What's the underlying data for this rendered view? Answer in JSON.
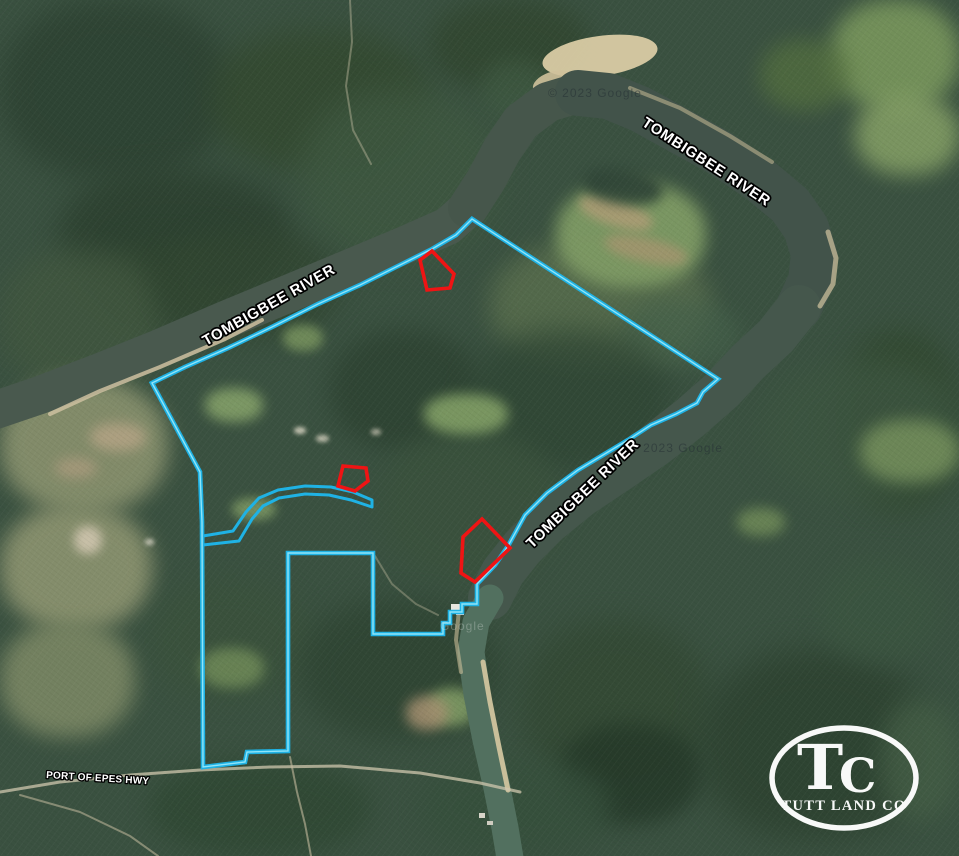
{
  "canvas": {
    "width": 959,
    "height": 856
  },
  "labels": {
    "river": [
      {
        "text": "TOMBIGBEE RIVER",
        "x": 641,
        "y": 125,
        "rotate": 33
      },
      {
        "text": "TOMBIGBEE RIVER",
        "x": 206,
        "y": 346,
        "rotate": -29.5
      },
      {
        "text": "TOMBIGBEE RIVER",
        "x": 532,
        "y": 549,
        "rotate": -44
      }
    ],
    "road": {
      "text": "PORT OF EPES HWY",
      "x": 46,
      "y": 778,
      "rotate": 3.5
    },
    "watermarks": [
      {
        "text": "© 2023 Google",
        "x": 548,
        "y": 97,
        "tone": "dark"
      },
      {
        "text": "© 2023 Google",
        "x": 629,
        "y": 452,
        "tone": "dark"
      },
      {
        "text": "Google",
        "x": 440,
        "y": 630,
        "tone": "light"
      }
    ]
  },
  "logo": {
    "monogram_t": "T",
    "monogram_c": "C",
    "name": "TUTT LAND CO"
  },
  "colors": {
    "boundary": "#1fb2e4",
    "boundary_core": "#9beafb",
    "outparcel": "#ef1414",
    "water": "#49594e",
    "sand": "#d5c7a0",
    "label_fill": "#ffffff",
    "label_stroke": "#000000"
  },
  "geometry": {
    "boundary": [
      [
        152,
        383
      ],
      [
        185,
        367
      ],
      [
        228,
        348
      ],
      [
        272,
        327
      ],
      [
        318,
        304
      ],
      [
        360,
        285
      ],
      [
        400,
        265
      ],
      [
        432,
        249
      ],
      [
        456,
        235
      ],
      [
        472,
        219
      ],
      [
        718,
        379
      ],
      [
        703,
        392
      ],
      [
        697,
        403
      ],
      [
        676,
        414
      ],
      [
        651,
        425
      ],
      [
        628,
        440
      ],
      [
        598,
        458
      ],
      [
        578,
        470
      ],
      [
        547,
        493
      ],
      [
        525,
        515
      ],
      [
        508,
        546
      ],
      [
        495,
        565
      ],
      [
        477,
        584
      ],
      [
        477,
        604
      ],
      [
        462,
        604
      ],
      [
        462,
        612
      ],
      [
        450,
        612
      ],
      [
        450,
        623
      ],
      [
        443,
        623
      ],
      [
        443,
        634
      ],
      [
        373,
        634
      ],
      [
        373,
        553
      ],
      [
        288,
        553
      ],
      [
        288,
        751
      ],
      [
        247,
        752
      ],
      [
        245,
        762
      ],
      [
        203,
        767
      ],
      [
        202,
        522
      ],
      [
        200,
        472
      ]
    ],
    "corridor": [
      [
        203,
        536
      ],
      [
        233,
        531
      ],
      [
        246,
        512
      ],
      [
        259,
        498
      ],
      [
        278,
        490
      ],
      [
        305,
        486
      ],
      [
        331,
        487
      ],
      [
        353,
        492
      ],
      [
        372,
        500
      ],
      [
        372,
        507
      ],
      [
        351,
        500
      ],
      [
        329,
        495
      ],
      [
        305,
        494
      ],
      [
        279,
        498
      ],
      [
        263,
        506
      ],
      [
        252,
        519
      ],
      [
        239,
        541
      ],
      [
        203,
        545
      ]
    ],
    "outparcels": [
      [
        [
          420,
          260
        ],
        [
          432,
          251
        ],
        [
          454,
          274
        ],
        [
          450,
          288
        ],
        [
          427,
          290
        ]
      ],
      [
        [
          343,
          466
        ],
        [
          366,
          468
        ],
        [
          368,
          481
        ],
        [
          355,
          491
        ],
        [
          338,
          486
        ]
      ],
      [
        [
          482,
          519
        ],
        [
          510,
          548
        ],
        [
          475,
          582
        ],
        [
          461,
          573
        ],
        [
          463,
          537
        ]
      ]
    ],
    "rivers": [
      {
        "points": [
          [
            -10,
            412
          ],
          [
            40,
            395
          ],
          [
            100,
            372
          ],
          [
            160,
            348
          ],
          [
            225,
            320
          ],
          [
            290,
            293
          ],
          [
            350,
            268
          ],
          [
            405,
            245
          ],
          [
            448,
            226
          ],
          [
            468,
            208
          ]
        ],
        "width": 38,
        "color": "#49594e"
      },
      {
        "points": [
          [
            468,
            208
          ],
          [
            486,
            180
          ],
          [
            502,
            150
          ],
          [
            521,
            122
          ],
          [
            548,
            102
          ],
          [
            578,
            93
          ]
        ],
        "width": 40,
        "color": "#46564b"
      },
      {
        "points": [
          [
            578,
            93
          ],
          [
            608,
            96
          ],
          [
            640,
            109
          ],
          [
            678,
            130
          ],
          [
            718,
            152
          ],
          [
            760,
            180
          ],
          [
            790,
            205
          ],
          [
            806,
            228
          ],
          [
            814,
            254
          ],
          [
            811,
            281
          ],
          [
            799,
            307
          ]
        ],
        "width": 46,
        "color": "#42534a"
      },
      {
        "points": [
          [
            799,
            307
          ],
          [
            776,
            336
          ],
          [
            748,
            362
          ],
          [
            722,
            390
          ],
          [
            690,
            418
          ],
          [
            654,
            446
          ],
          [
            616,
            472
          ],
          [
            580,
            496
          ],
          [
            548,
            522
          ],
          [
            522,
            548
          ],
          [
            503,
            572
          ],
          [
            490,
            598
          ]
        ],
        "width": 44,
        "color": "#45574c"
      },
      {
        "points": [
          [
            490,
            598
          ],
          [
            476,
            622
          ],
          [
            471,
            652
          ],
          [
            477,
            694
          ],
          [
            486,
            740
          ],
          [
            497,
            788
          ],
          [
            505,
            828
          ],
          [
            510,
            858
          ]
        ],
        "width": 27,
        "color": "#52705f"
      }
    ],
    "beaches": [
      {
        "cx": 600,
        "cy": 56,
        "rx": 58,
        "ry": 20,
        "rot": -8,
        "color": "#d9cba4",
        "op": 0.95
      },
      {
        "cx": 552,
        "cy": 82,
        "rx": 20,
        "ry": 10,
        "rot": -20,
        "color": "#cfc19b",
        "op": 0.9
      }
    ],
    "sandbars": [
      {
        "points": [
          [
            50,
            414
          ],
          [
            100,
            391
          ],
          [
            160,
            367
          ],
          [
            225,
            339
          ],
          [
            262,
            320
          ]
        ],
        "width": 4,
        "color": "#cdbfa0",
        "op": 0.85
      },
      {
        "points": [
          [
            630,
            88
          ],
          [
            680,
            108
          ],
          [
            730,
            136
          ],
          [
            772,
            162
          ]
        ],
        "width": 4,
        "color": "#c9bb96",
        "op": 0.55
      },
      {
        "points": [
          [
            828,
            232
          ],
          [
            836,
            258
          ],
          [
            833,
            284
          ],
          [
            820,
            306
          ]
        ],
        "width": 5,
        "color": "#d3c59f",
        "op": 0.7
      },
      {
        "points": [
          [
            483,
            662
          ],
          [
            490,
            702
          ],
          [
            499,
            747
          ],
          [
            508,
            790
          ]
        ],
        "width": 5,
        "color": "#d6c8a1",
        "op": 0.9
      },
      {
        "points": [
          [
            459,
            610
          ],
          [
            456,
            640
          ],
          [
            461,
            672
          ]
        ],
        "width": 4,
        "color": "#cabc97",
        "op": 0.6
      }
    ],
    "roads": [
      {
        "points": [
          [
            0,
            792
          ],
          [
            60,
            782
          ],
          [
            130,
            775
          ],
          [
            200,
            770
          ],
          [
            270,
            767
          ],
          [
            340,
            766
          ],
          [
            420,
            773
          ],
          [
            480,
            783
          ],
          [
            520,
            792
          ]
        ],
        "width": 3,
        "color": "#cfc7ae",
        "op": 0.75
      },
      {
        "points": [
          [
            20,
            795
          ],
          [
            80,
            812
          ],
          [
            130,
            836
          ],
          [
            158,
            856
          ]
        ],
        "width": 2,
        "color": "#c4bb9e",
        "op": 0.55
      },
      {
        "points": [
          [
            290,
            757
          ],
          [
            297,
            792
          ],
          [
            305,
            824
          ],
          [
            311,
            856
          ]
        ],
        "width": 2,
        "color": "#c4bb9e",
        "op": 0.6
      },
      {
        "points": [
          [
            350,
            0
          ],
          [
            352,
            42
          ],
          [
            346,
            86
          ],
          [
            353,
            130
          ],
          [
            371,
            164
          ]
        ],
        "width": 2,
        "color": "#bdb89e",
        "op": 0.45
      },
      {
        "points": [
          [
            375,
            556
          ],
          [
            392,
            584
          ],
          [
            416,
            604
          ],
          [
            438,
            615
          ]
        ],
        "width": 2,
        "color": "#bdb89e",
        "op": 0.4
      }
    ],
    "structures": [
      {
        "x": 451,
        "y": 604,
        "w": 11,
        "h": 7,
        "color": "#e8e6df"
      },
      {
        "x": 456,
        "y": 612,
        "w": 8,
        "h": 3,
        "color": "#cfd4d6"
      },
      {
        "x": 479,
        "y": 813,
        "w": 6,
        "h": 5,
        "color": "#d8d5c9"
      },
      {
        "x": 487,
        "y": 821,
        "w": 6,
        "h": 4,
        "color": "#cfccc0"
      }
    ]
  }
}
